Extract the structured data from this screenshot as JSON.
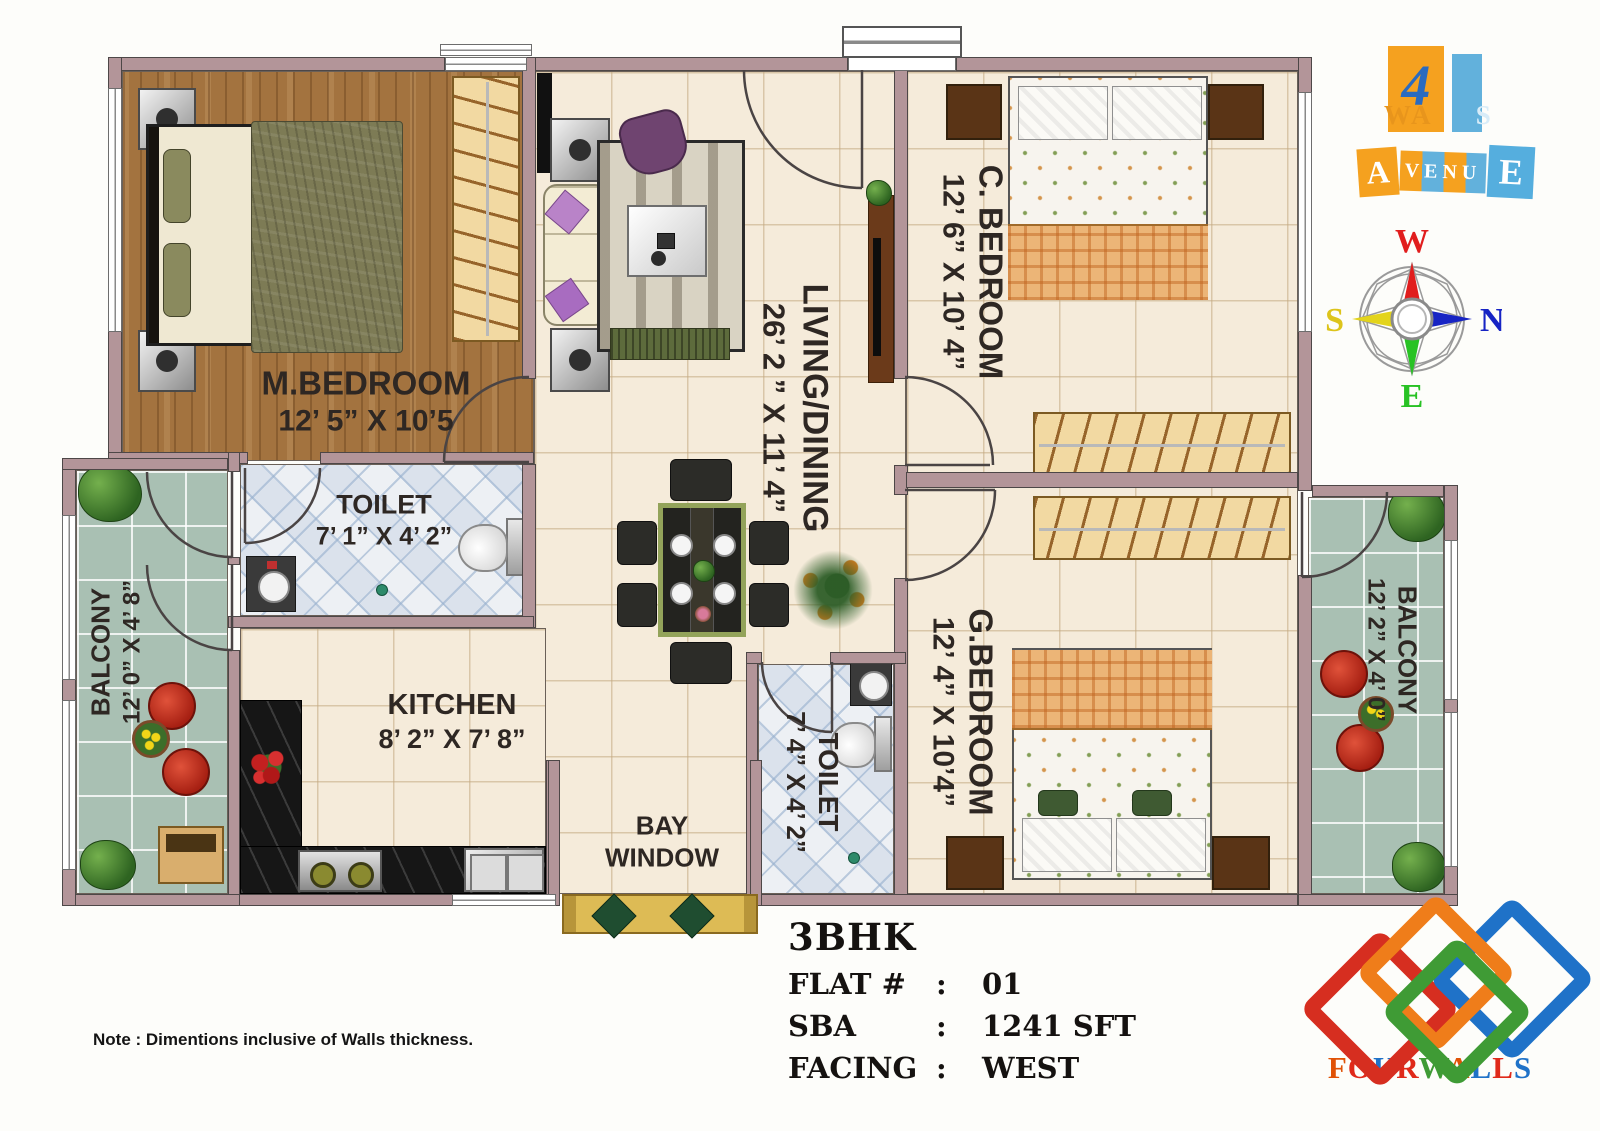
{
  "plan": {
    "rooms": {
      "m_bedroom": {
        "name": "M.BEDROOM",
        "dims": "12’ 5” X 10’5"
      },
      "toilet_1": {
        "name": "TOILET",
        "dims": "7’ 1” X 4’ 2”"
      },
      "kitchen": {
        "name": "KITCHEN",
        "dims": "8’ 2” X 7’ 8”"
      },
      "living_dining": {
        "name": "LIVING/DINING",
        "dims": "26’ 2 ” X 11’ 4”"
      },
      "c_bedroom": {
        "name": "C. BEDROOM",
        "dims": "12’ 6” X 10’ 4”"
      },
      "g_bedroom": {
        "name": "G.BEDROOM",
        "dims": "12’ 4” X 10’4”"
      },
      "toilet_2": {
        "name": "TOILET",
        "dims": "7’ 4” X 4’ 2”"
      },
      "balcony_left": {
        "name": "BALCONY",
        "dims": "12’ 0” X 4’ 8”"
      },
      "balcony_right": {
        "name": "BALCONY",
        "dims": "12’ 2” X 4’ 0”"
      },
      "bay_window": {
        "line1": "BAY",
        "line2": "WINDOW"
      }
    }
  },
  "summary": {
    "bhk": "3BHK",
    "colon": ":",
    "rows": [
      {
        "label": "FLAT #",
        "value": "01"
      },
      {
        "label": "SBA",
        "value": "1241 SFT"
      },
      {
        "label": "FACING",
        "value": "WEST"
      }
    ]
  },
  "footer": {
    "note": "Note : Dimentions inclusive of Walls thickness."
  },
  "compass": {
    "top": "W",
    "right": "N",
    "left": "S",
    "bottom": "E",
    "colors": {
      "top": "#e11d1d",
      "right": "#1724c4",
      "left": "#ddc41b",
      "bottom": "#28c224"
    }
  },
  "branding": {
    "logo_top": {
      "numeral": "4",
      "walls_wa": "WA",
      "walls_s": "S",
      "avenue_a": "A",
      "avenue_mid": "VENU",
      "avenue_e": "E",
      "orange": "#f5a11f",
      "blue": "#62b1dc"
    },
    "fourwalls": {
      "letters": [
        {
          "ch": "F",
          "color": "#e05206"
        },
        {
          "ch": "O",
          "color": "#e02a1a"
        },
        {
          "ch": "U",
          "color": "#1f72c8"
        },
        {
          "ch": "R",
          "color": "#e02a1a"
        },
        {
          "ch": "W",
          "color": "#3f9b35"
        },
        {
          "ch": "A",
          "color": "#e05206"
        },
        {
          "ch": "L",
          "color": "#1f72c8"
        },
        {
          "ch": "L",
          "color": "#e02a1a"
        },
        {
          "ch": "S",
          "color": "#1f72c8"
        }
      ],
      "diamond_colors": [
        "#d62e20",
        "#ef7d1a",
        "#3f9b35",
        "#1f72c8"
      ]
    }
  }
}
